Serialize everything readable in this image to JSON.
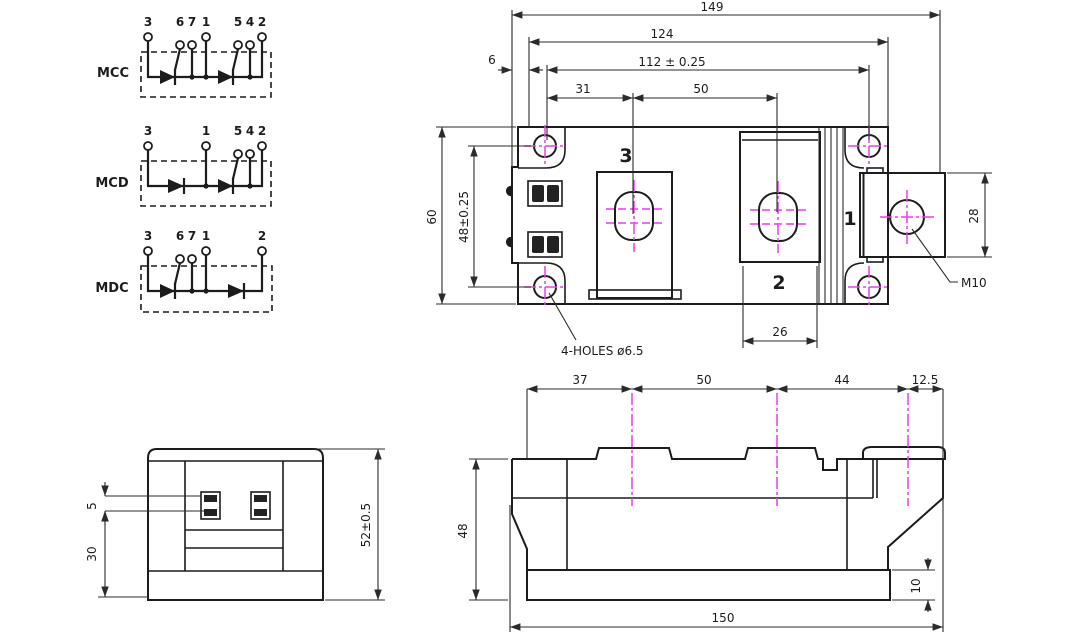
{
  "colors": {
    "ink": "#1c1c1c",
    "centerline": "#ee3cee",
    "background": "#ffffff"
  },
  "circuits": {
    "items": [
      {
        "label": "MCC",
        "terminals": [
          "3",
          "6",
          "7",
          "1",
          "5",
          "4",
          "2"
        ]
      },
      {
        "label": "MCD",
        "terminals": [
          "3",
          "1",
          "5",
          "4",
          "2"
        ]
      },
      {
        "label": "MDC",
        "terminals": [
          "3",
          "6",
          "7",
          "1",
          "2"
        ]
      }
    ]
  },
  "top_view": {
    "dims": {
      "overall_width": "149",
      "body_width": "124",
      "hole_pitch_x": "112 ± 0.25",
      "offset_31": "31",
      "pitch_50": "50",
      "edge_6": "6",
      "body_height": "60",
      "hole_pitch_y": "48±0.25",
      "terminal2_width": "26",
      "terminal1_height": "28"
    },
    "labels": {
      "terminal1": "1",
      "terminal2": "2",
      "terminal3": "3",
      "bolt": "M10",
      "holes_note": "4-HOLES ø6.5"
    }
  },
  "front_view": {
    "dims": {
      "tab_pitch": "5",
      "height_30": "30",
      "overall_height": "52±0.5"
    }
  },
  "side_view": {
    "dims": {
      "seg_37": "37",
      "seg_50": "50",
      "seg_44": "44",
      "seg_12_5": "12.5",
      "body_height": "48",
      "base_height": "10",
      "overall_length": "150"
    }
  }
}
